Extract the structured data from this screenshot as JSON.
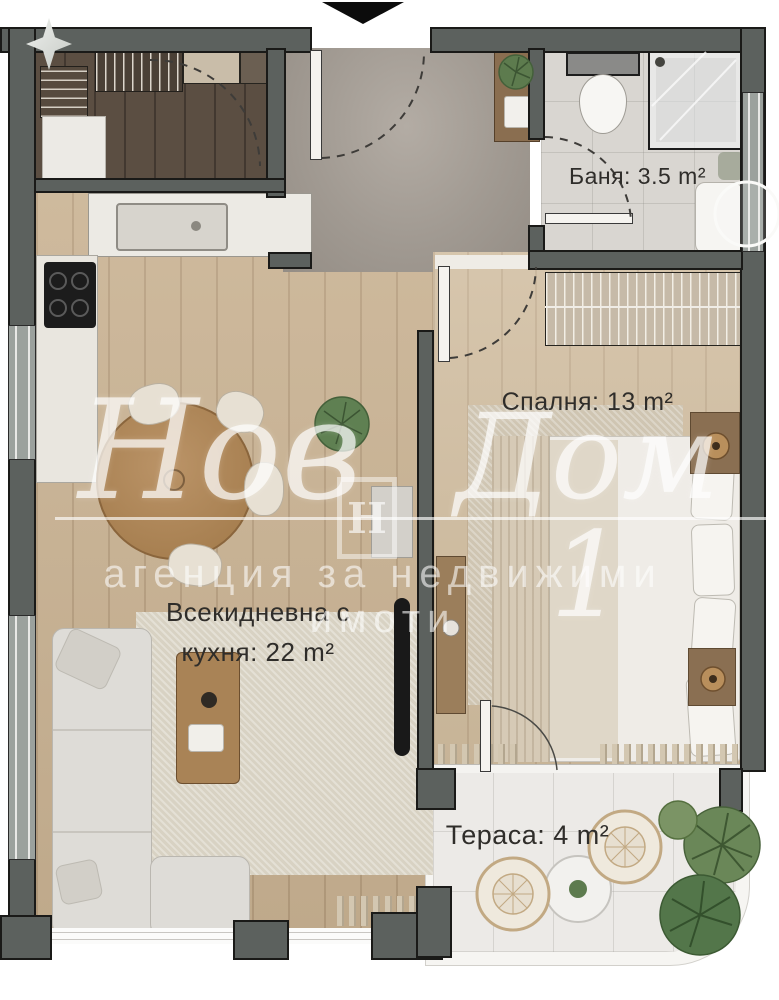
{
  "plan": {
    "type": "apartment-floor-plan",
    "rooms": [
      {
        "id": "bathroom",
        "name": "Баня",
        "area_m2": 3.5,
        "label": "Баня: 3.5 m²"
      },
      {
        "id": "bedroom",
        "name": "Спалня",
        "area_m2": 13,
        "label": "Спалня: 13 m²"
      },
      {
        "id": "living_kitchen",
        "name": "Всекидневна с кухня",
        "area_m2": 22,
        "label_line1": "Всекидневна с",
        "label_line2": "кухня: 22 m²"
      },
      {
        "id": "terrace",
        "name": "Тераса",
        "area_m2": 4,
        "label": "Тераса: 4 m²"
      }
    ]
  },
  "watermark": {
    "brand_word1": "Нов",
    "brand_word2": "Дом 1",
    "logo_letter": "H",
    "subtitle": "агенция за недвижими имоти"
  },
  "icons": {
    "entrance_marker": "black triangle pointing down at entry door",
    "sparkle": "four-point star glyph top-left"
  },
  "colors": {
    "wall": "#5c615e",
    "wall_outline": "#1a1a18",
    "window": "#9ba19d",
    "wood": "#c9b292",
    "wood_light": "#cfbb9d",
    "hall_floor": "#a8a19a",
    "bath_floor": "#d9d6d1",
    "closet_floor": "#5b4e42",
    "terrace_floor": "#eceae7",
    "rug": "#d8d2c3",
    "sofa": "#dedcd7",
    "label_text": "#2f2d2a",
    "watermark": "#ffffff",
    "plant_green": "#5f8052",
    "table_wood": "#b08a5e"
  }
}
